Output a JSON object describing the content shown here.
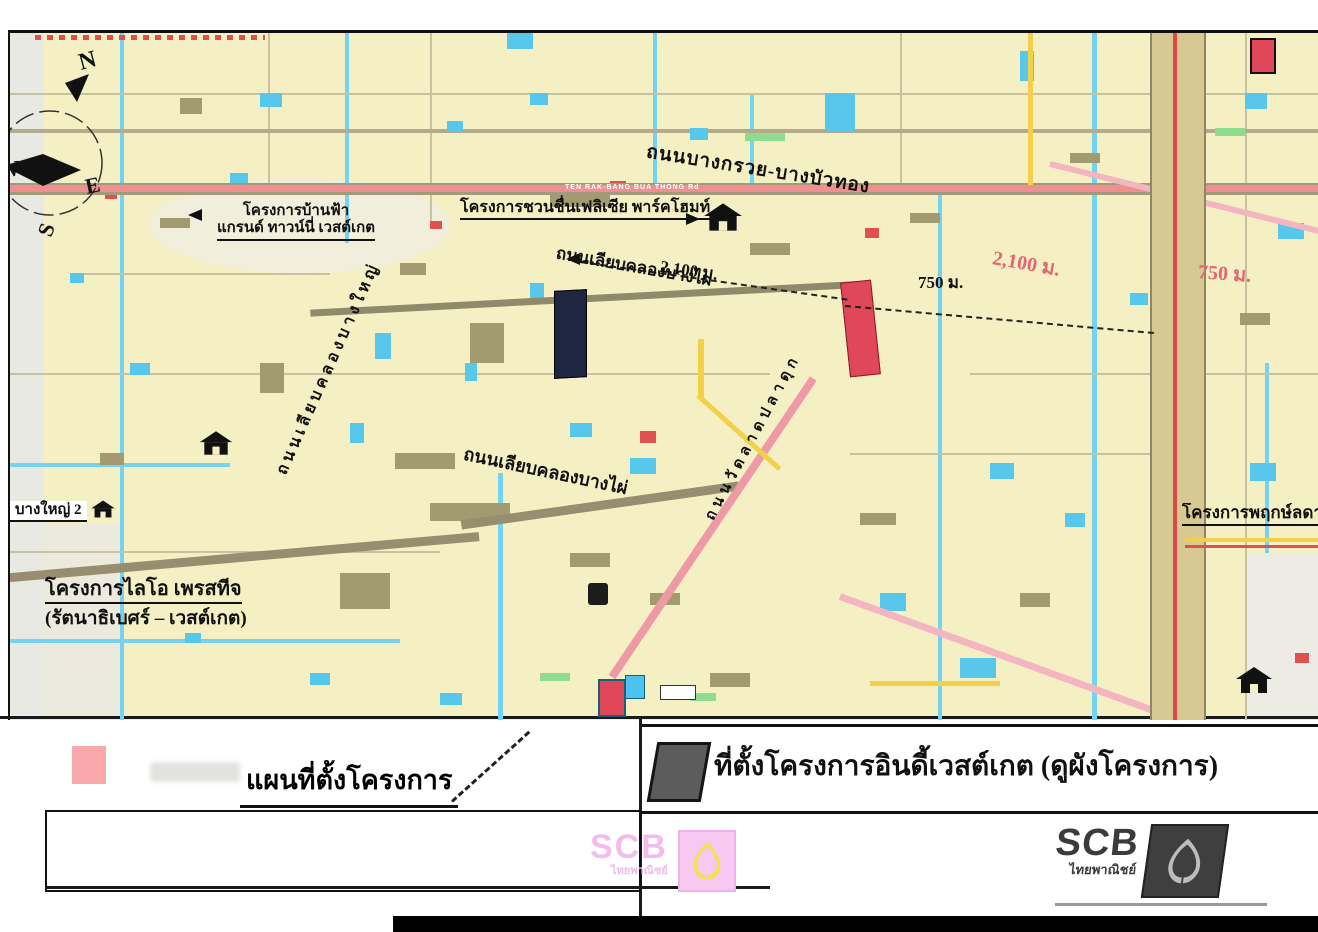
{
  "compass": {
    "n": "N",
    "e": "E",
    "w": "W",
    "s": "S"
  },
  "map_labels": {
    "project_banfah_1": "โครงการบ้านฟ้า",
    "project_banfah_2": "แกรนด์ ทาวน์นี่ เวสต์เกต",
    "project_chuanchuen": "โครงการชวนชื่นเฟลิเซีย พาร์คโฮมท์",
    "project_lio_1": "โครงการไลโอ เพรสทีจ",
    "project_lio_2": "(รัตนาธิเบศร์ – เวสต์เกต)",
    "project_pruek": "โครงการพฤกษ์ลดา",
    "place_bangyai2": "บางใหญ่ 2",
    "road_bangkruai_bangbuathong": "ถนนบางกรวย-บางบัวทอง",
    "road_liap_klong_bang_phai_top": "ถนนเลียบคลองบางไผ่",
    "road_liap_klong_bang_phai_bottom": "ถนนเลียบคลองบางไผ่",
    "road_wat_lat_pla_duk": "ถนนวัดลาดปลาดุก",
    "road_liap_klong_bang_yai": "ถนนเลียบคลองบางใหญ่",
    "road_en": "TEN RAK-BANG BUA THONG Rd",
    "dist_2100_a": "2,100 ม.",
    "dist_750_a": "750 ม.",
    "dist_2100_b": "2,100 ม.",
    "dist_750_b": "750 ม."
  },
  "legend": {
    "left_title": "แผนที่ตั้งโครงการ",
    "right_text": "ที่ตั้งโครงการอินดี้เวสต์เกต (ดูผังโครงการ)"
  },
  "branding": {
    "scb_acronym": "SCB",
    "scb_thai": "ไทยพาณิชย์"
  },
  "colors": {
    "map_bg": "#f5f0c4",
    "water": "#74d2f2",
    "road_red": "#ef8f8f",
    "road_yellow": "#f3d04a",
    "highway_tan": "#d8c993",
    "site_red": "#e0485a",
    "site_dark": "#1f2740",
    "legend_pink": "#f9a8ab",
    "legend_dark": "#5c5c5c",
    "distance_red": "#e26673",
    "scb_pink": "#f2bced",
    "scb_yellow": "#f3e34d"
  }
}
